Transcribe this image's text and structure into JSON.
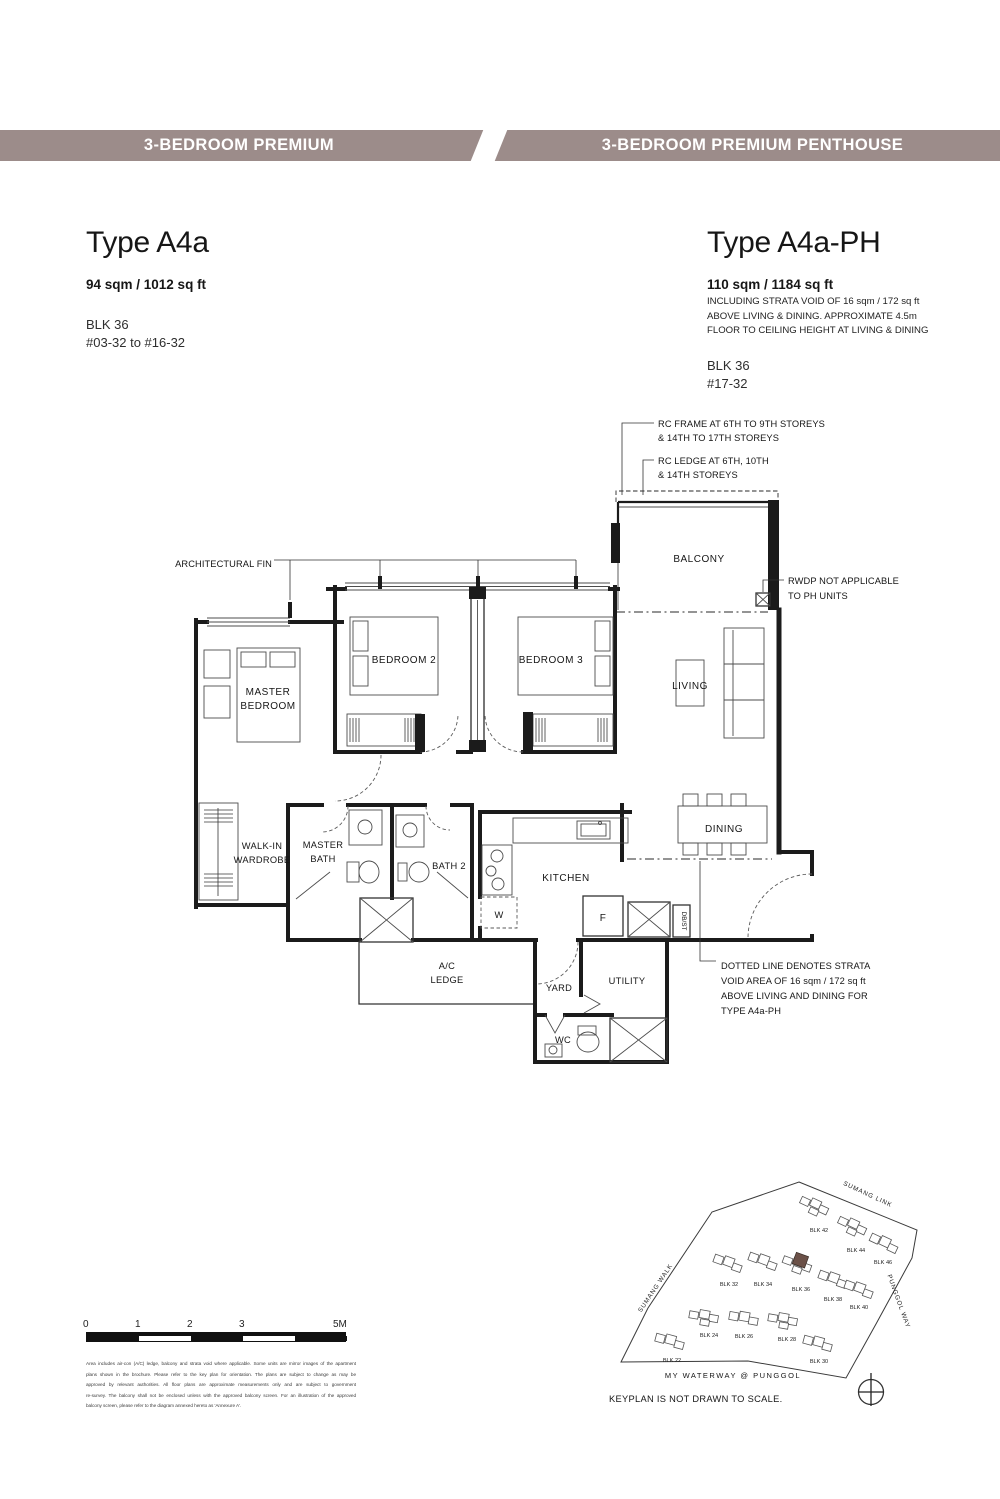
{
  "theme": {
    "banner_color": "#9c8c8a",
    "highlight_color": "#6b5148"
  },
  "header": {
    "left_tab": "3-BEDROOM PREMIUM",
    "right_tab": "3-BEDROOM PREMIUM PENTHOUSE"
  },
  "unit_left": {
    "title": "Type A4a",
    "area": "94 sqm / 1012 sq ft",
    "block": "BLK 36",
    "levels": "#03-32 to #16-32"
  },
  "unit_right": {
    "title": "Type A4a-PH",
    "area": "110 sqm / 1184 sq ft",
    "note_lines": [
      "INCLUDING STRATA VOID OF 16 sqm / 172 sq ft",
      "ABOVE LIVING & DINING. APPROXIMATE 4.5m",
      "FLOOR TO CEILING HEIGHT AT LIVING & DINING"
    ],
    "block": "BLK 36",
    "levels": "#17-32"
  },
  "plan": {
    "rooms": {
      "master_bedroom": [
        "MASTER",
        "BEDROOM"
      ],
      "bedroom2": "BEDROOM 2",
      "bedroom3": "BEDROOM 3",
      "living": "LIVING",
      "dining": "DINING",
      "balcony": "BALCONY",
      "kitchen": "KITCHEN",
      "master_bath": [
        "MASTER",
        "BATH"
      ],
      "bath2": "BATH 2",
      "walk_in_wardrobe": [
        "WALK-IN",
        "WARDROBE"
      ],
      "yard": "YARD",
      "utility": "UTILITY",
      "wc": "WC",
      "ac_ledge": [
        "A/C",
        "LEDGE"
      ],
      "washer": "W",
      "fridge": "F",
      "db_st": "DB/ST"
    },
    "annotations": {
      "architectural_fin": "ARCHITECTURAL FIN",
      "rc_frame": [
        "RC FRAME AT 6TH TO 9TH STOREYS",
        "& 14TH TO 17TH STOREYS"
      ],
      "rc_ledge": [
        "RC LEDGE AT 6TH, 10TH",
        "& 14TH STOREYS"
      ],
      "rwdp": [
        "RWDP NOT APPLICABLE",
        "TO PH UNITS"
      ],
      "strata_void": [
        "DOTTED LINE DENOTES STRATA",
        "VOID AREA OF 16 sqm / 172 sq ft",
        "ABOVE LIVING AND DINING FOR",
        "TYPE A4a-PH"
      ]
    }
  },
  "scale_bar": {
    "tick_labels": [
      "0",
      "1",
      "2",
      "3",
      "5M"
    ]
  },
  "disclaimer_lines": [
    "Area includes air-con (A/C) ledge, balcony and strata void where applicable. Some units are mirror images of the apartment",
    "plans shown in the brochure. Please refer to the key plan for orientation. The plans are subject to change as may be",
    "approved by relevant authorities. All floor plans are approximate measurements only and are subject to government",
    "re-survey. The balcony shall not be enclosed unless with the approved balcony screen. For an illustration of the approved",
    "balcony screen, please refer to the diagram annexed hereto as 'Annexure A'."
  ],
  "keyplan": {
    "note": "KEYPLAN IS NOT DRAWN TO SCALE.",
    "waterway_label": "MY WATERWAY @ PUNGGOL",
    "streets": {
      "sumang_link": "SUMANG LINK",
      "sumang_walk": "SUMANG WALK",
      "punggol_way": "PUNGGOL WAY"
    },
    "blocks": [
      {
        "label": "BLK 42",
        "highlighted": false
      },
      {
        "label": "BLK 44",
        "highlighted": false
      },
      {
        "label": "BLK 46",
        "highlighted": false
      },
      {
        "label": "BLK 32",
        "highlighted": false
      },
      {
        "label": "BLK 34",
        "highlighted": false
      },
      {
        "label": "BLK 36",
        "highlighted": true
      },
      {
        "label": "BLK 38",
        "highlighted": false
      },
      {
        "label": "BLK 40",
        "highlighted": false
      },
      {
        "label": "BLK 22",
        "highlighted": false
      },
      {
        "label": "BLK 24",
        "highlighted": false
      },
      {
        "label": "BLK 26",
        "highlighted": false
      },
      {
        "label": "BLK 28",
        "highlighted": false
      },
      {
        "label": "BLK 30",
        "highlighted": false
      }
    ]
  }
}
